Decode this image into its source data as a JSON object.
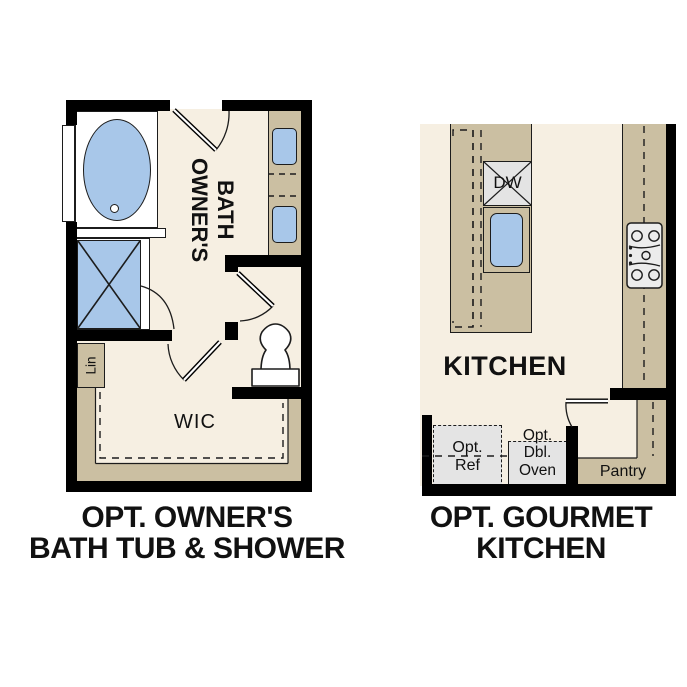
{
  "colors": {
    "floor": "#f6efe2",
    "cabinet": "#cbbfa2",
    "fixture": "#a8c7e9",
    "appliance": "#e4e4e4",
    "wall": "#000000",
    "line": "#1c1c1c",
    "white": "#ffffff",
    "text": "#111111"
  },
  "bath": {
    "caption_line1": "OPT. OWNER'S",
    "caption_line2": "BATH TUB & SHOWER",
    "room_line1": "OWNER'S",
    "room_line2": "BATH",
    "linen": "Lin",
    "closet": "WIC"
  },
  "kitchen": {
    "caption_line1": "OPT. GOURMET",
    "caption_line2": "KITCHEN",
    "room": "KITCHEN",
    "dishwasher": "DW",
    "fridge_line1": "Opt.",
    "fridge_line2": "Ref",
    "oven_line1": "Opt.",
    "oven_line2": "Dbl.",
    "oven_line3": "Oven",
    "pantry": "Pantry"
  }
}
